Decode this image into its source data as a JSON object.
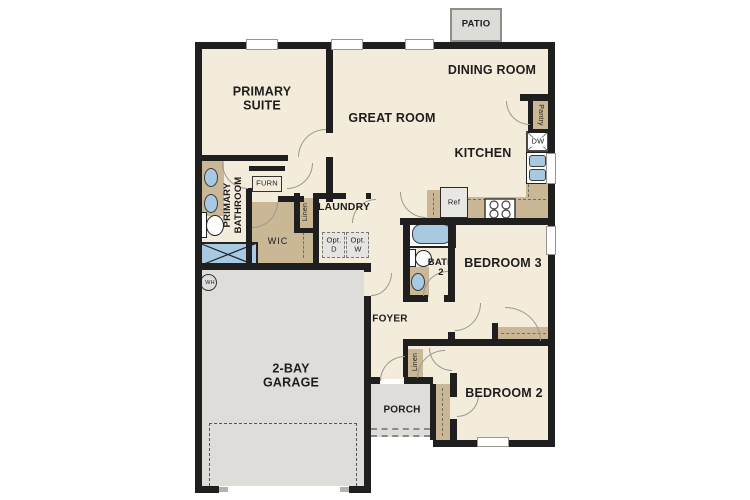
{
  "floorplan": {
    "labels": {
      "patio": "PATIO",
      "dining_room": "DINING ROOM",
      "primary_suite": "PRIMARY\nSUITE",
      "great_room": "GREAT ROOM",
      "kitchen": "KITCHEN",
      "pantry": "Pantry",
      "dw": "DW",
      "ref": "Ref",
      "furn": "FURN",
      "laundry": "LAUNDRY",
      "linen": "Linen",
      "opt_d": "Opt.\nD",
      "opt_w": "Opt.\nW",
      "wic": "WIC",
      "primary_bathroom": "PRIMARY\nBATHROOM",
      "bath2": "BATH\n2",
      "bedroom3": "BEDROOM 3",
      "foyer": "FOYER",
      "garage": "2-BAY\nGARAGE",
      "porch": "PORCH",
      "bedroom2": "BEDROOM 2",
      "wh": "WH"
    },
    "colors": {
      "wall": "#1f1f1f",
      "room_fill": "#f4ecdb",
      "cabinet_tan": "#c9b795",
      "concrete_gray": "#deddda",
      "fixture_blue": "#a7c9e2",
      "door_arc": "#9a9990"
    }
  }
}
